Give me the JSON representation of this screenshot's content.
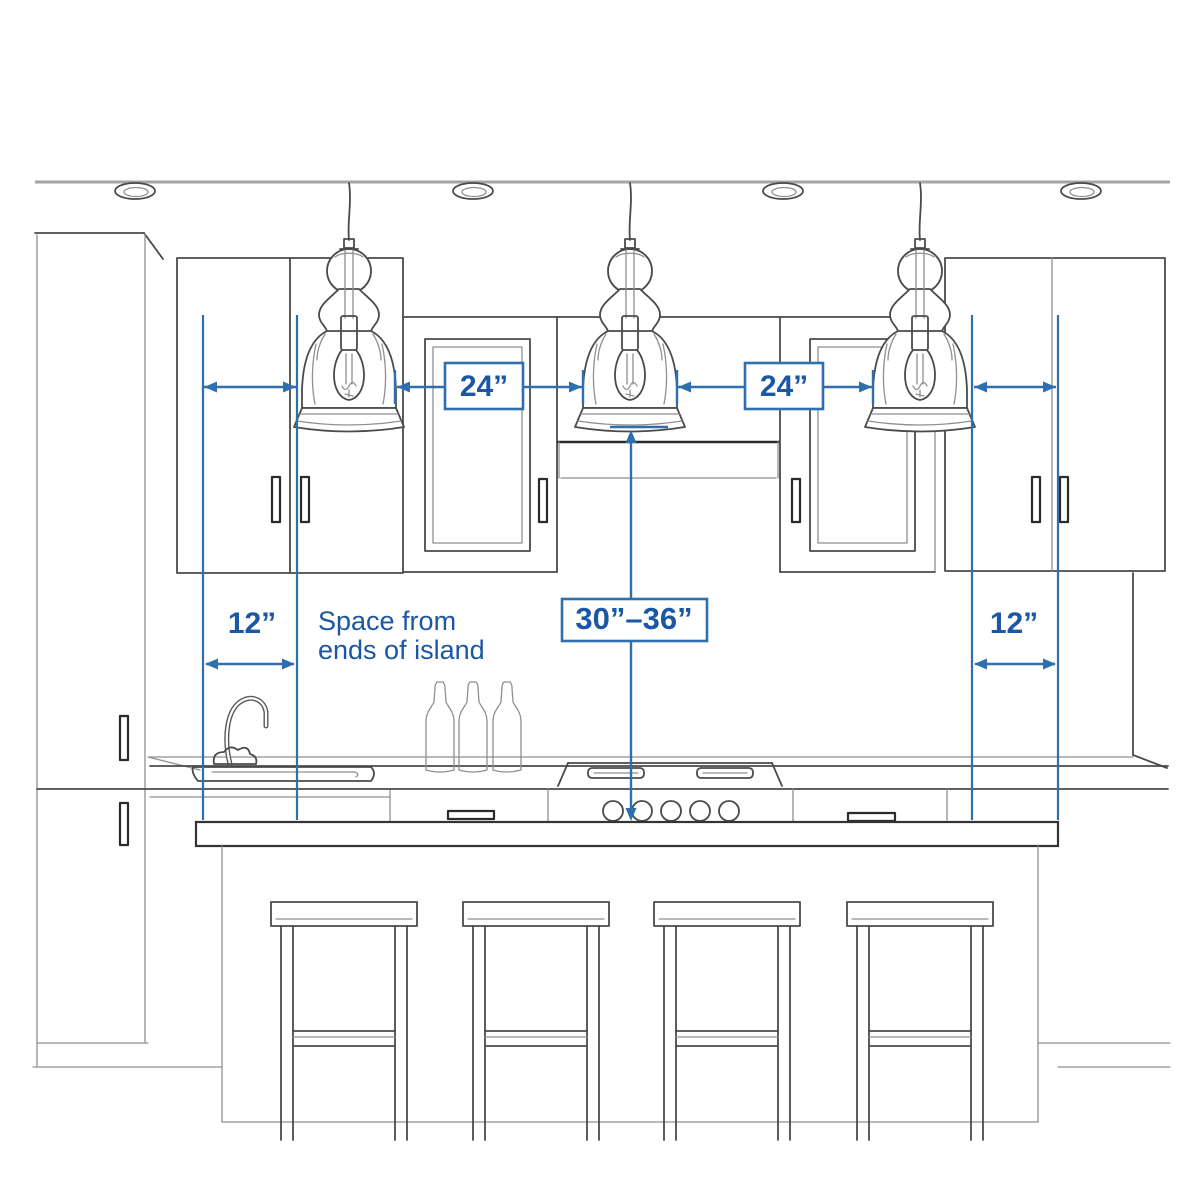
{
  "diagram": {
    "title": "Kitchen island pendant light spacing guide",
    "annotations": {
      "gap_between_pendants_left": "24”",
      "gap_between_pendants_right": "24”",
      "end_space_left": "12”",
      "end_space_right": "12”",
      "height_above_counter": "30”–36”",
      "note_line1": "Space from",
      "note_line2": "ends of island"
    },
    "scene": {
      "pendant_count": 3,
      "recessed_light_count": 4,
      "bar_stool_count": 4,
      "bottle_count": 3
    },
    "colors": {
      "measurement_blue": "#2f6fad",
      "label_text_blue": "#1a57a4",
      "sketch_gray": "#4a4a4a",
      "background": "#ffffff"
    }
  }
}
